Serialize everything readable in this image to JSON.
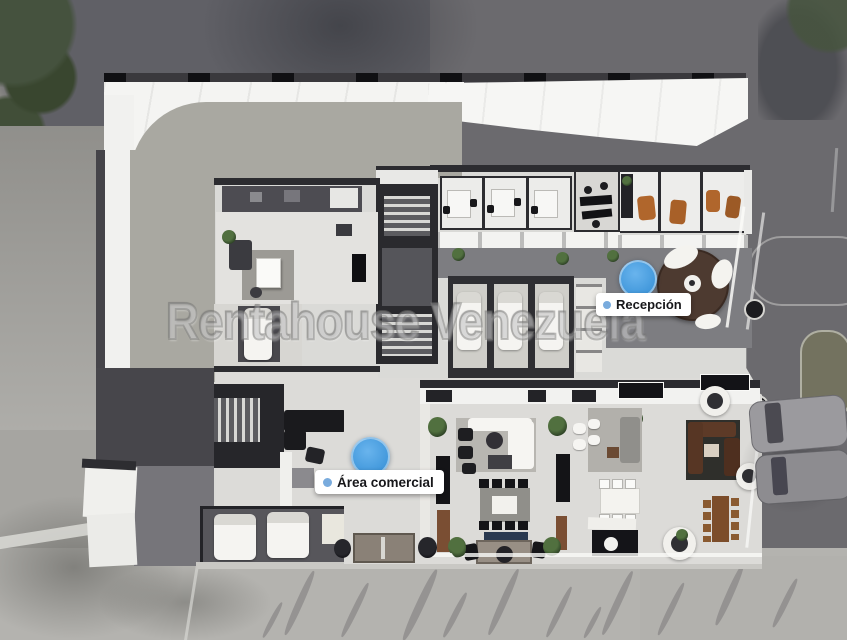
{
  "scene": {
    "type": "3d-floorplan-render",
    "watermark": "Rentahouse Venezuela",
    "labels": {
      "reception": "Recepción",
      "commercial": "Área comercial"
    },
    "colors": {
      "marker_blue": "#4ea4e6",
      "label_background": "#ffffff",
      "label_text": "#17171a",
      "street_dark": "#6b6a6e",
      "pavement_light": "#b4b3af",
      "sidewalk": "#908f8b",
      "terrace": "#a9a8a1",
      "floor_light": "#dcdbd8",
      "wall_white": "#f3f3f1",
      "wall_dark": "#2b2b2f",
      "reception_desk_brown": "#4d3a30",
      "accent_chair_orange": "#b0662c",
      "sofa_brown": "#5d3a27"
    }
  }
}
